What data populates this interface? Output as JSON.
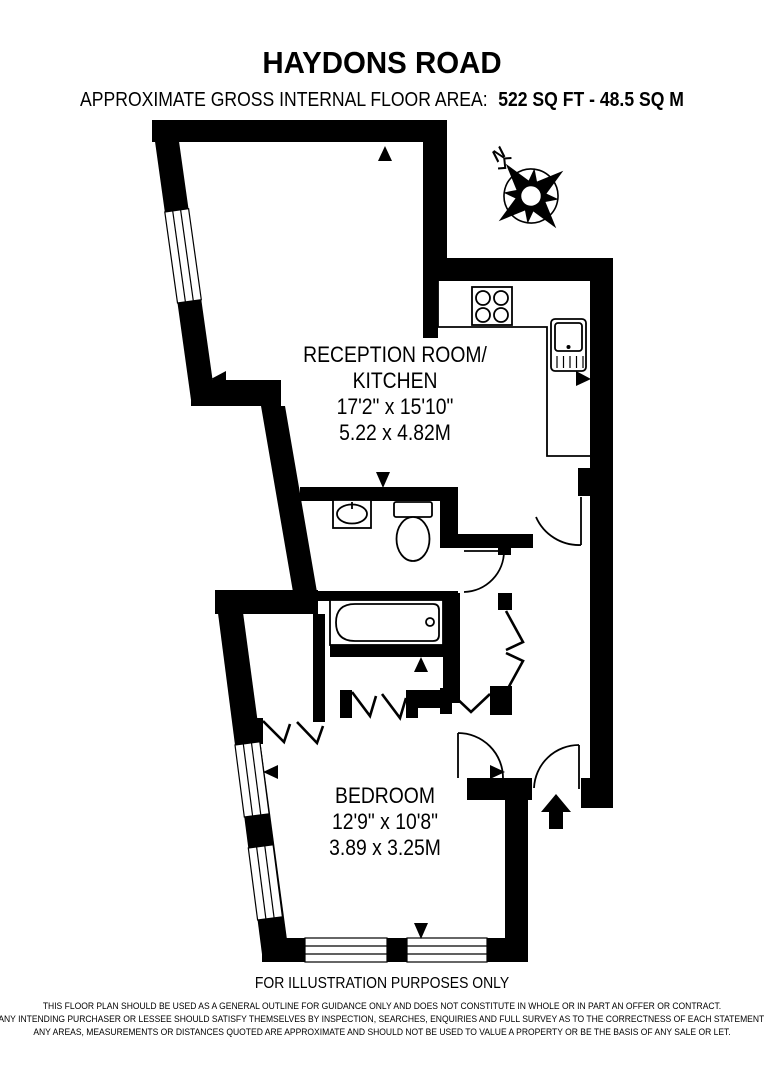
{
  "header": {
    "title": "HAYDONS ROAD",
    "area_label": "APPROXIMATE GROSS INTERNAL FLOOR AREA:",
    "area_value": "522 SQ FT  -  48.5 SQ M"
  },
  "compass": {
    "north_label": "N"
  },
  "rooms": [
    {
      "id": "reception-kitchen",
      "lines": [
        "RECEPTION ROOM/",
        "KITCHEN",
        "17'2\" x 15'10\"",
        "5.22 x 4.82M"
      ]
    },
    {
      "id": "bedroom",
      "lines": [
        "BEDROOM",
        "12'9\" x 10'8\"",
        "3.89 x 3.25M"
      ]
    }
  ],
  "footer": {
    "notice": "FOR ILLUSTRATION PURPOSES ONLY",
    "disclaimer_lines": [
      "THIS FLOOR PLAN SHOULD BE USED AS A GENERAL OUTLINE FOR GUIDANCE ONLY AND DOES NOT CONSTITUTE IN WHOLE OR IN PART AN OFFER OR CONTRACT.",
      "ANY INTENDING PURCHASER OR LESSEE SHOULD SATISFY THEMSELVES BY INSPECTION, SEARCHES, ENQUIRIES AND FULL SURVEY AS TO THE CORRECTNESS OF EACH STATEMENT.",
      "ANY AREAS, MEASUREMENTS OR DISTANCES QUOTED ARE APPROXIMATE AND SHOULD NOT BE USED TO VALUE A PROPERTY OR BE THE BASIS OF ANY SALE OR LET."
    ]
  },
  "colors": {
    "ink": "#000000",
    "background": "#ffffff"
  },
  "icons": [
    "compass-rose",
    "entry-arrow",
    "measure-arrow",
    "window",
    "door-arc",
    "bathtub",
    "toilet",
    "wash-basin",
    "kitchen-sink",
    "hob"
  ]
}
